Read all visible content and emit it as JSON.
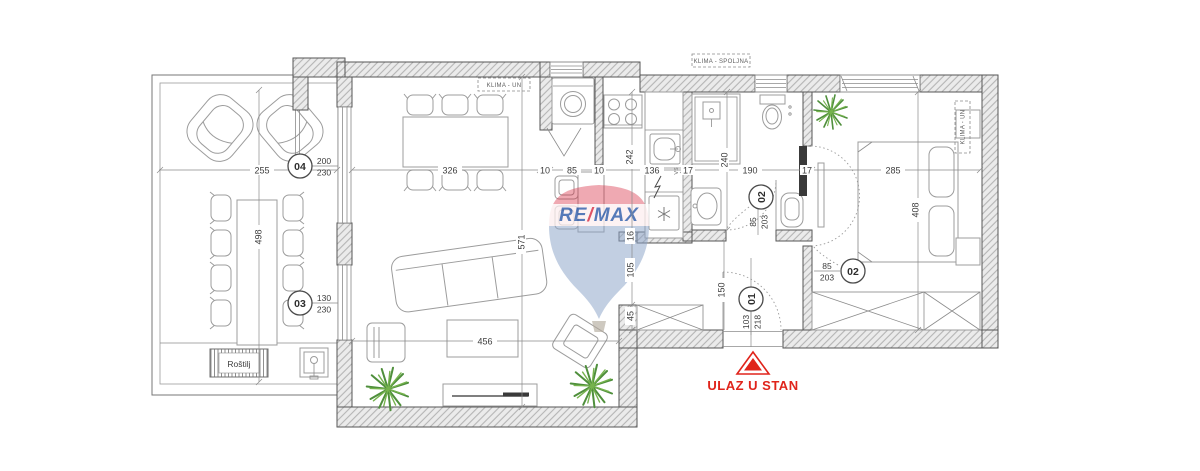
{
  "colors": {
    "accent_red": "#e0241b",
    "plant_green_dark": "#4f8f3c",
    "plant_green_light": "#76b34d",
    "logo_blue": "#2d59a8",
    "logo_red": "#d6273e",
    "wall_outline": "#565656",
    "dimension_text": "#3d3d3d"
  },
  "labels": {
    "entrance": "ULAZ U STAN",
    "grill": "Roštilj",
    "klima_un_living": "KLIMA - UN",
    "klima_spoljna": "KLIMA - SPOLJNA",
    "klima_un_bedroom": "KLIMA - UN",
    "ventilation": "VS"
  },
  "logo": {
    "re": "RE",
    "slash": "/",
    "max": "MAX"
  },
  "doors": {
    "d01": {
      "no": "01",
      "width": "103",
      "height": "218"
    },
    "d02_bath": {
      "no": "02",
      "width": "85",
      "height": "203"
    },
    "d02_bedroom": {
      "no": "02",
      "width": "85",
      "height": "203"
    },
    "d03": {
      "no": "03",
      "width": "130",
      "height": "230"
    },
    "d04": {
      "no": "04",
      "width": "200",
      "height": "230"
    }
  },
  "dimensions": {
    "terrace_width": "255",
    "terrace_depth": "498",
    "living_width": "326",
    "living_depth": "571",
    "living_lower_width": "456",
    "niche_wall_left": "10",
    "washing_niche_width": "85",
    "niche_wall_right": "10",
    "kitchen_width": "136",
    "kitchen_depth": "242",
    "wall_kitchen_bath": "17",
    "bath_width": "190",
    "bath_depth": "240",
    "wall_bath_bedroom": "17",
    "bedroom_width": "285",
    "bedroom_depth": "408",
    "hall_wall_segment": "16",
    "hall_opening": "105",
    "hall_closet_depth": "45",
    "hall_width": "150"
  }
}
